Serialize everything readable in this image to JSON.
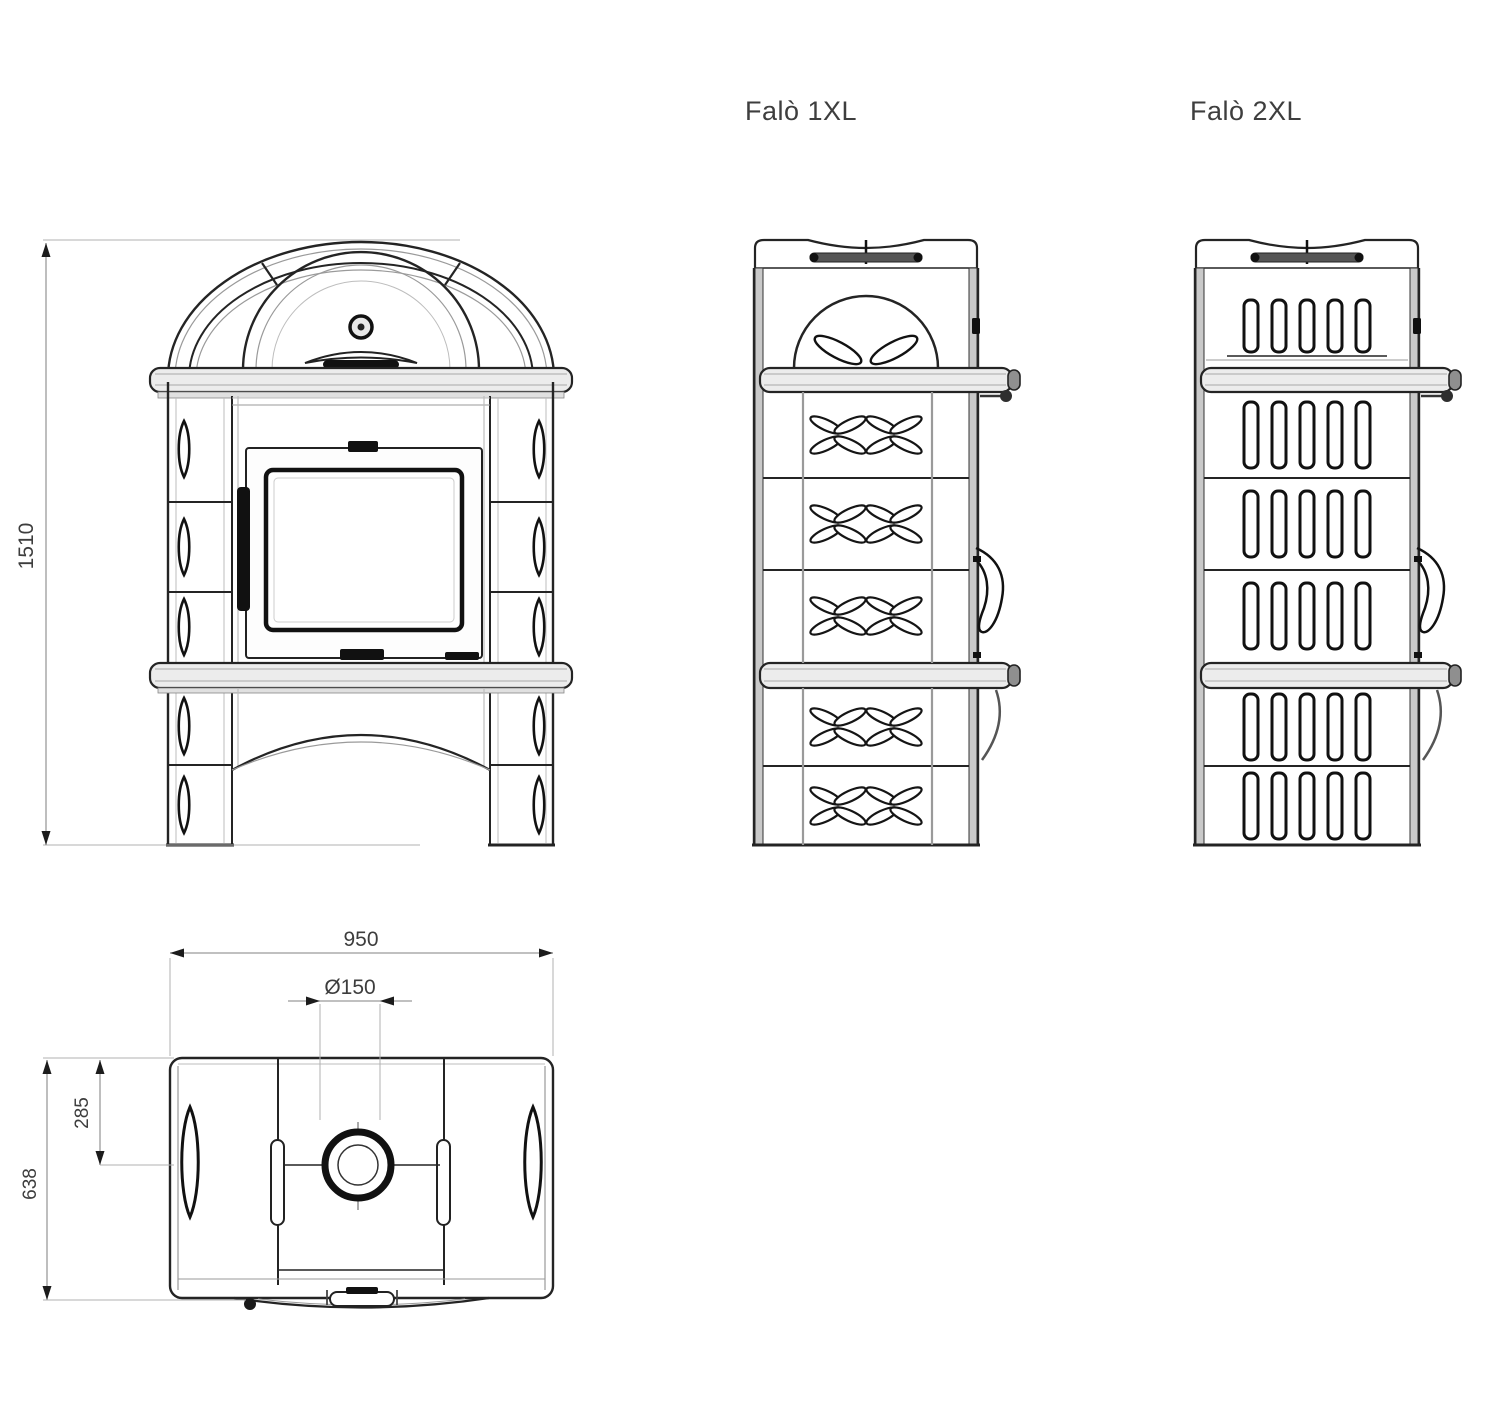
{
  "labels": {
    "side_1xl": "Falò 1XL",
    "side_2xl": "Falò 2XL"
  },
  "dimensions": {
    "height": "1510",
    "width": "950",
    "flue_diameter": "Ø150",
    "flue_offset": "285",
    "depth": "638"
  },
  "colors": {
    "line": "#242424",
    "dim_line": "#9b9b9b",
    "dim_text": "#3d3d3d",
    "shelf_fill": "#ececec"
  }
}
